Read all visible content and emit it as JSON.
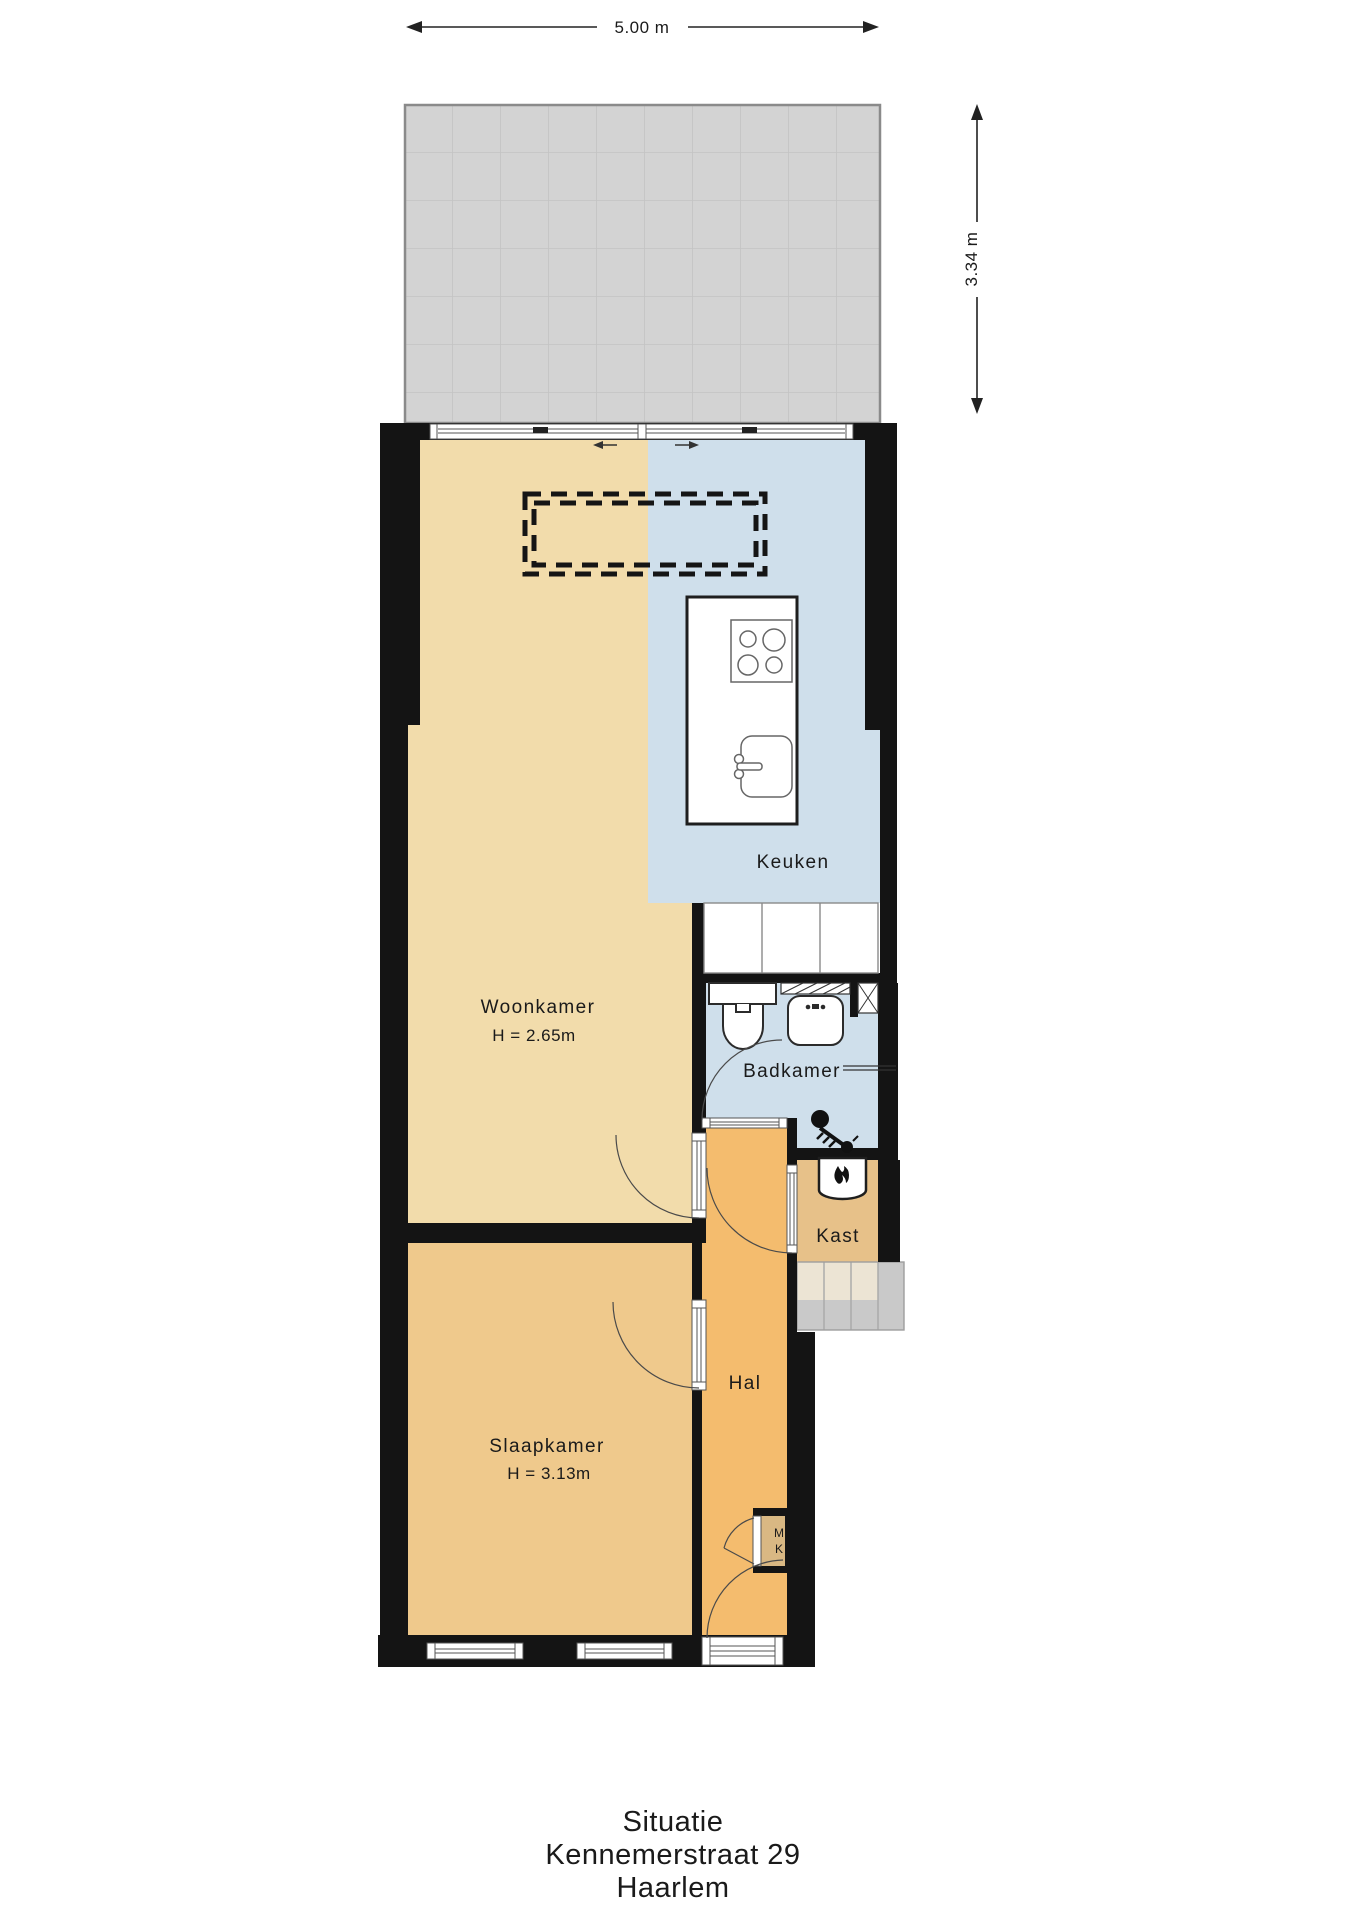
{
  "title": "Situatie Kennemerstraat 29 Haarlem floor plan",
  "dims": {
    "width": "5.00 m",
    "depth": "3.34 m"
  },
  "rooms": {
    "keuken": {
      "label": "Keuken"
    },
    "woonkamer": {
      "label": "Woonkamer",
      "height": "H = 2.65m"
    },
    "badkamer": {
      "label": "Badkamer"
    },
    "kast": {
      "label": "Kast"
    },
    "hal": {
      "label": "Hal"
    },
    "slaapkamer": {
      "label": "Slaapkamer",
      "height": "H = 3.13m"
    },
    "meterkast": {
      "line1": "M",
      "line2": "K"
    }
  },
  "caption": {
    "line1": "Situatie",
    "line2": "Kennemerstraat 29",
    "line3": "Haarlem"
  },
  "icons": [
    "stove-icon",
    "sink-icon",
    "toilet-icon",
    "washbasin-icon",
    "shower-icon",
    "boiler-flame-icon",
    "stairs",
    "slide-direction-arrows"
  ],
  "colors": {
    "wall": "#141414",
    "woonkamer": "#f2dcab",
    "keuken": "#cfdfeb",
    "badkamer": "#cfdfeb",
    "slaapkamer": "#efc98c",
    "hal": "#f4bc6e",
    "kast": "#e7c189",
    "meterkast": "#d9b883",
    "terras": "#d3d3d3",
    "terras-grid": "#c3c3c3",
    "terras-border": "#8a8a8a",
    "stairs-light": "#ece4d4",
    "stairs-gray": "#c9c9c9",
    "text": "#1a1a1a"
  }
}
